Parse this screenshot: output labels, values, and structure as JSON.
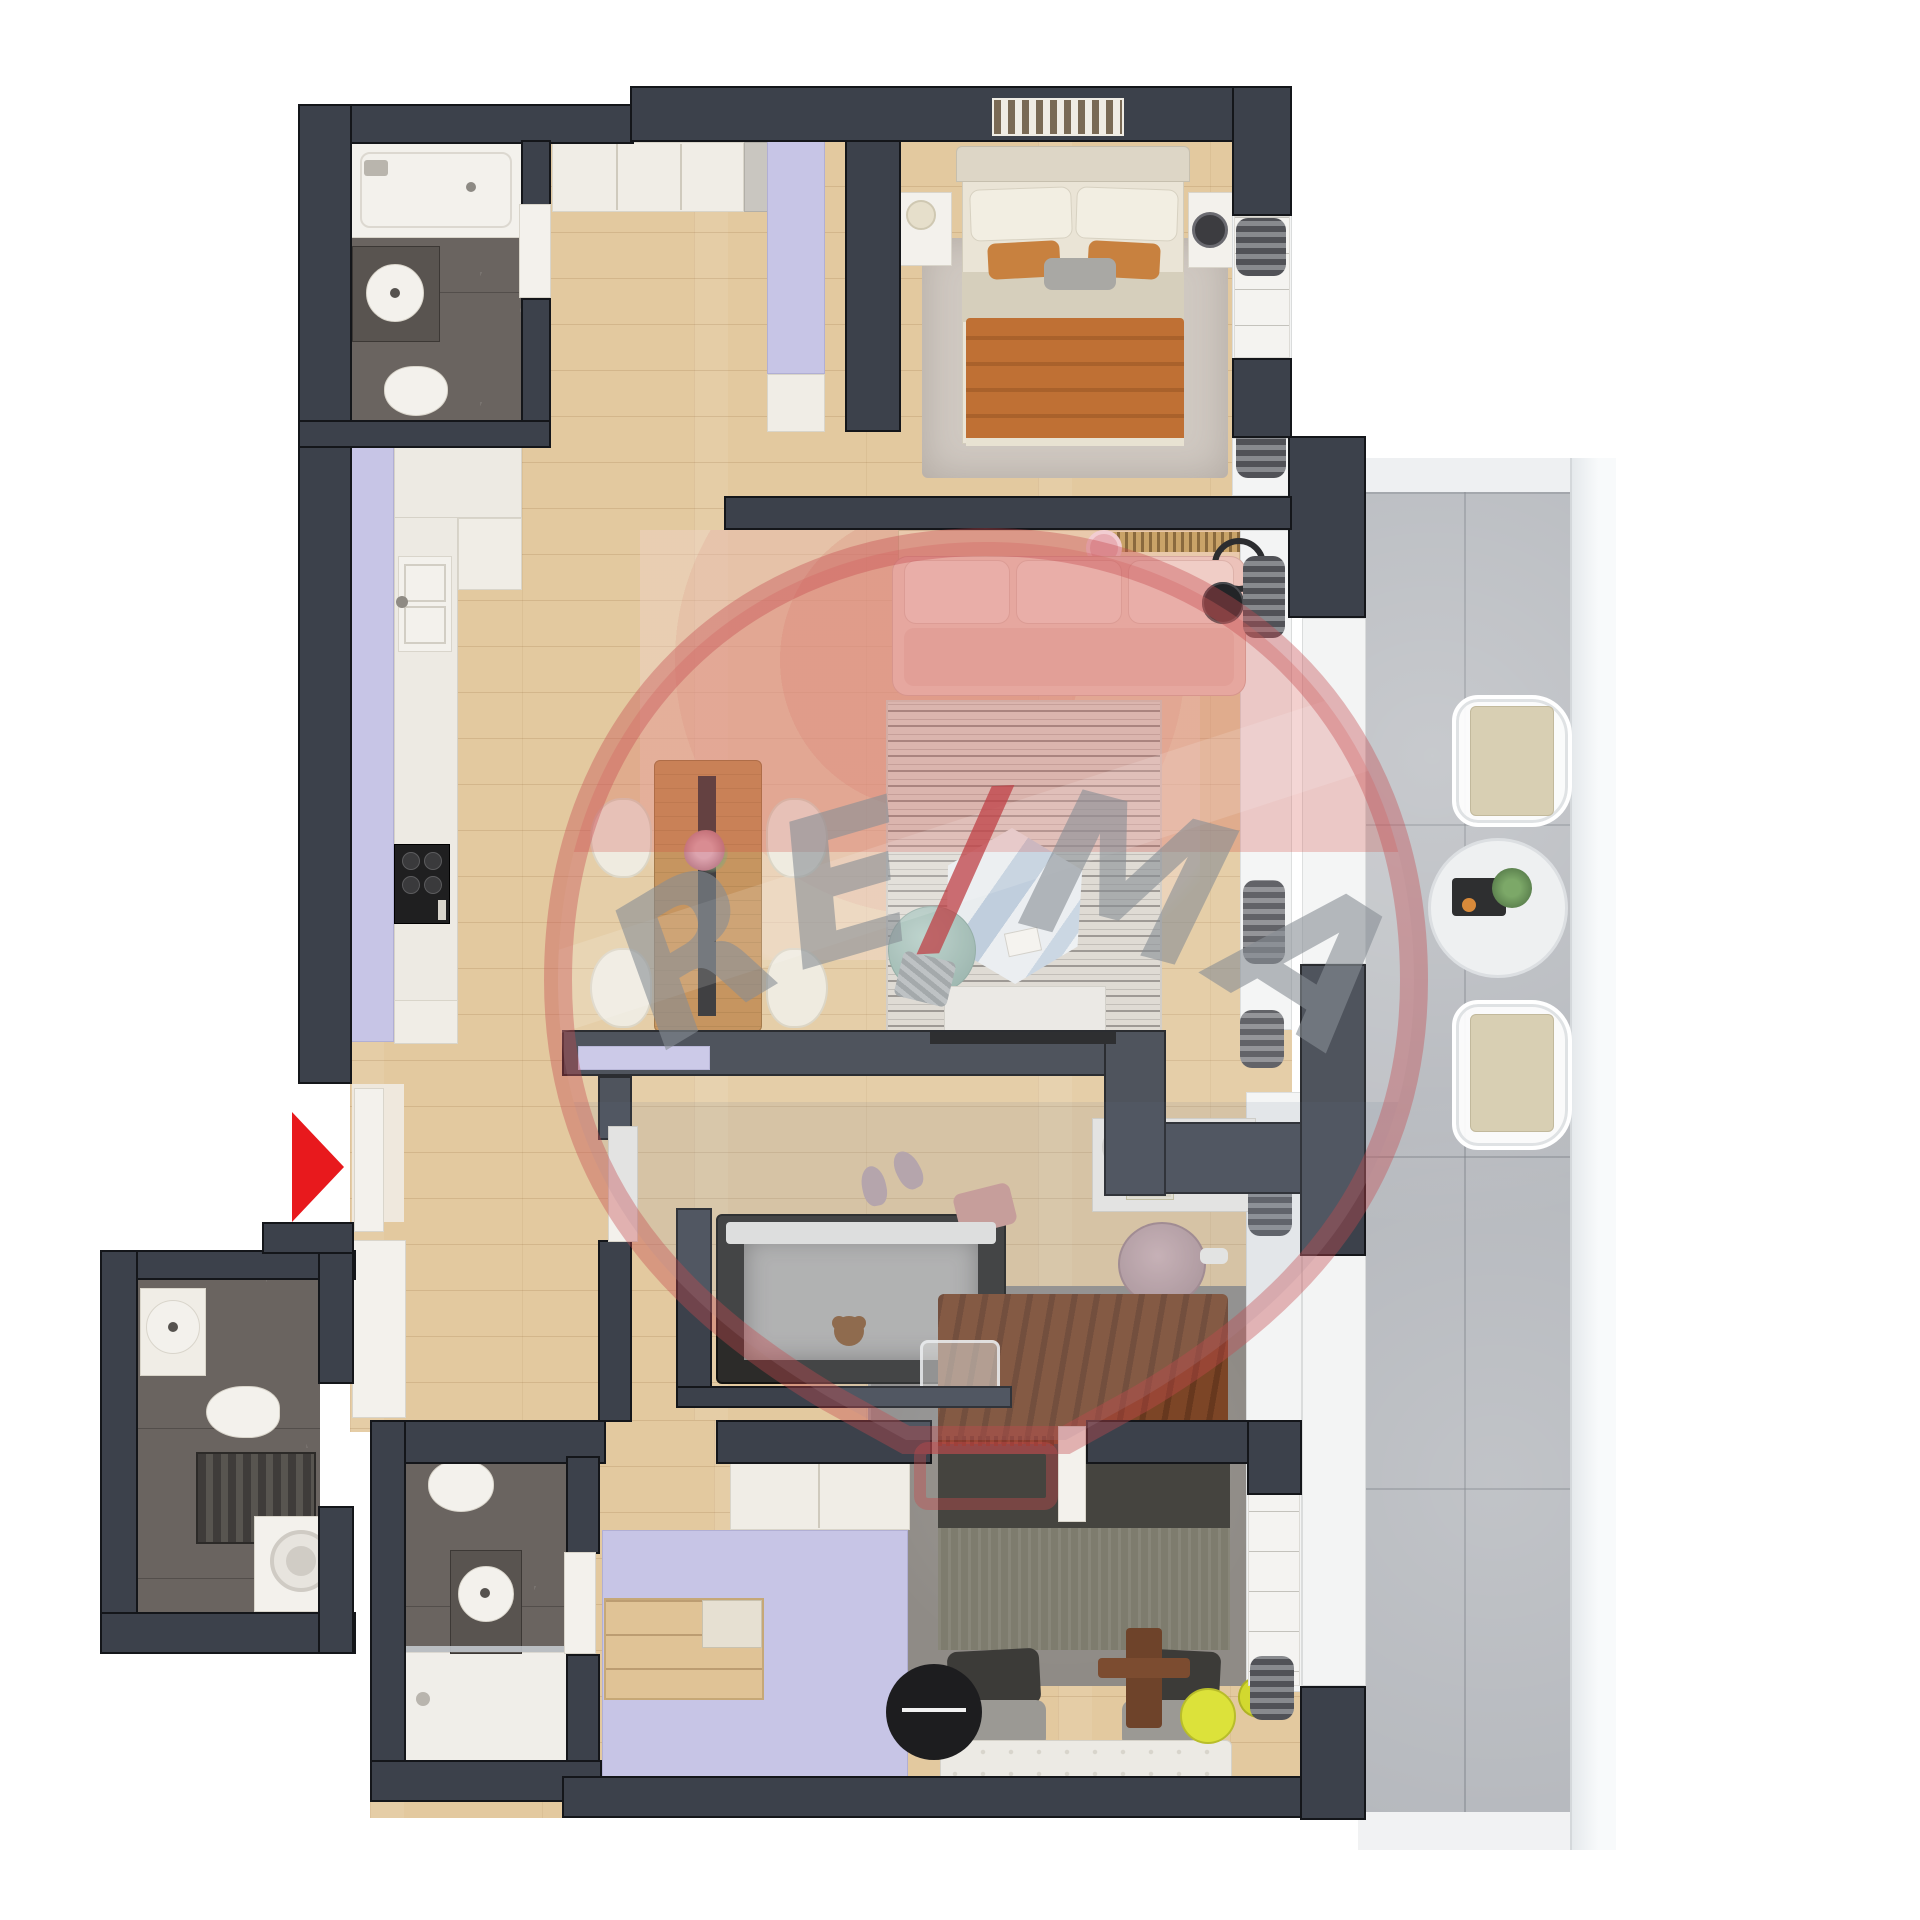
{
  "image": {
    "kind": "3d-apartment-floor-plan-render",
    "width": 1920,
    "height": 1920,
    "background": "#ffffff",
    "view": "top-down"
  },
  "watermark": {
    "brand": "RE/MAX",
    "re": "RE",
    "slash": "/",
    "max": "MAX",
    "balloon_color": "#c64a50",
    "text_color": "#878e94",
    "slash_color": "#bf4046"
  },
  "entrance_marker": {
    "icon": "red-triangle-arrow",
    "direction": "right",
    "color": "#e8191d"
  },
  "palette": {
    "wall": "#3c414b",
    "wall_outline": "#14161a",
    "wood_floor": "#e3c99f",
    "dark_marble": "#6a6460",
    "fixture_white": "#f3f1ec",
    "cabinet_white": "#f0ede6",
    "wardrobe_lavender": "#c7c5e6",
    "balcony_tile": "#b5b8bd",
    "balcony_rail": "#eef1f4",
    "sofa_pink": "#ecc2ba",
    "rug_pink": "#e8b9b1",
    "rug_living": "#dcd7d0",
    "rug_bedroom": "#d0c9c2",
    "rug_bedroom2": "#8f8b86",
    "blanket_orange": "#bf7034",
    "throw_brown": "#7c4526",
    "bed2_dark": "#45443f",
    "dining_wood": "#c08a4e",
    "chair_cream": "#eee9dd",
    "pouf_teal": "#a9c3bb",
    "coffee_table_marble": "#dfe6eb",
    "accent_yellow": "#dce23a",
    "crib_dark": "#2c2b29",
    "desk_chair_mauve": "#c3a4a8",
    "arrow_red": "#e8191d"
  },
  "rooms": [
    {
      "name": "bathroom-main-top-left",
      "features": [
        "bathtub",
        "dark-vanity",
        "round-sink",
        "toilet",
        "dark-marble-floor",
        "door"
      ]
    },
    {
      "name": "bedroom-1-top-right",
      "features": [
        "double-bed",
        "cream-headboard",
        "white-pillows",
        "orange-accent-pillows",
        "orange-blanket",
        "area-rug",
        "nightstand-left",
        "nightstand-right",
        "table-lamp",
        "black-lamp",
        "wall-art",
        "window-dresser",
        "dark-curtains"
      ]
    },
    {
      "name": "entry-hallway",
      "features": [
        "lavender-wardrobe",
        "entry-closet",
        "white-sideboard",
        "entrance-door"
      ]
    },
    {
      "name": "kitchen",
      "features": [
        "lavender-countertop-run",
        "marble-worktop",
        "double-sink",
        "gas-hob",
        "base-cabinets"
      ]
    },
    {
      "name": "living-dining-room",
      "features": [
        "pink-three-seat-sofa",
        "media-shelf",
        "slatted-curtain-track",
        "black-floor-lamp",
        "round-pink-rug",
        "striped-gray-rug",
        "hexagonal-marble-coffee-table",
        "teal-knit-pouf",
        "gray-throw",
        "tv-console",
        "wall-tv",
        "wooden-dining-table",
        "black-table-runner",
        "flower-vase",
        "four-cream-chairs",
        "dark-curtains"
      ]
    },
    {
      "name": "nursery-study",
      "features": [
        "sliding-pocket-door",
        "white-door-leaf",
        "baby-crib",
        "crib-mattress",
        "teddy-bear",
        "laundry-basket",
        "slippers",
        "pink-blanket",
        "white-desk",
        "desk-tray",
        "books",
        "potted-plant",
        "mauve-office-chair",
        "dark-curtains"
      ]
    },
    {
      "name": "bathroom-2-middle",
      "features": [
        "toilet",
        "dark-vanity",
        "round-sink",
        "walk-in-shower",
        "glass-screen",
        "door"
      ]
    },
    {
      "name": "bathroom-3-laundry",
      "features": [
        "round-sink-shelf",
        "toilet",
        "dark-radiator",
        "washing-machine",
        "dark-marble-floor"
      ]
    },
    {
      "name": "bedroom-2-bottom",
      "features": [
        "double-bed",
        "brown-fringed-throw",
        "dark-duvet",
        "gray-pillows",
        "wooden-bed-caddy",
        "tufted-bench",
        "black-round-side-table",
        "yellow-stool",
        "yellow-chair",
        "area-rug",
        "lavender-wardrobe",
        "open-shelf-unit",
        "white-cabinet",
        "window-dresser",
        "dark-curtains"
      ]
    },
    {
      "name": "balcony",
      "features": [
        "concrete-tile-floor",
        "white-wire-chair-north",
        "white-wire-chair-south",
        "beige-seat-cushions",
        "round-white-table",
        "serving-tray",
        "potted-plant",
        "white-railing"
      ]
    }
  ]
}
